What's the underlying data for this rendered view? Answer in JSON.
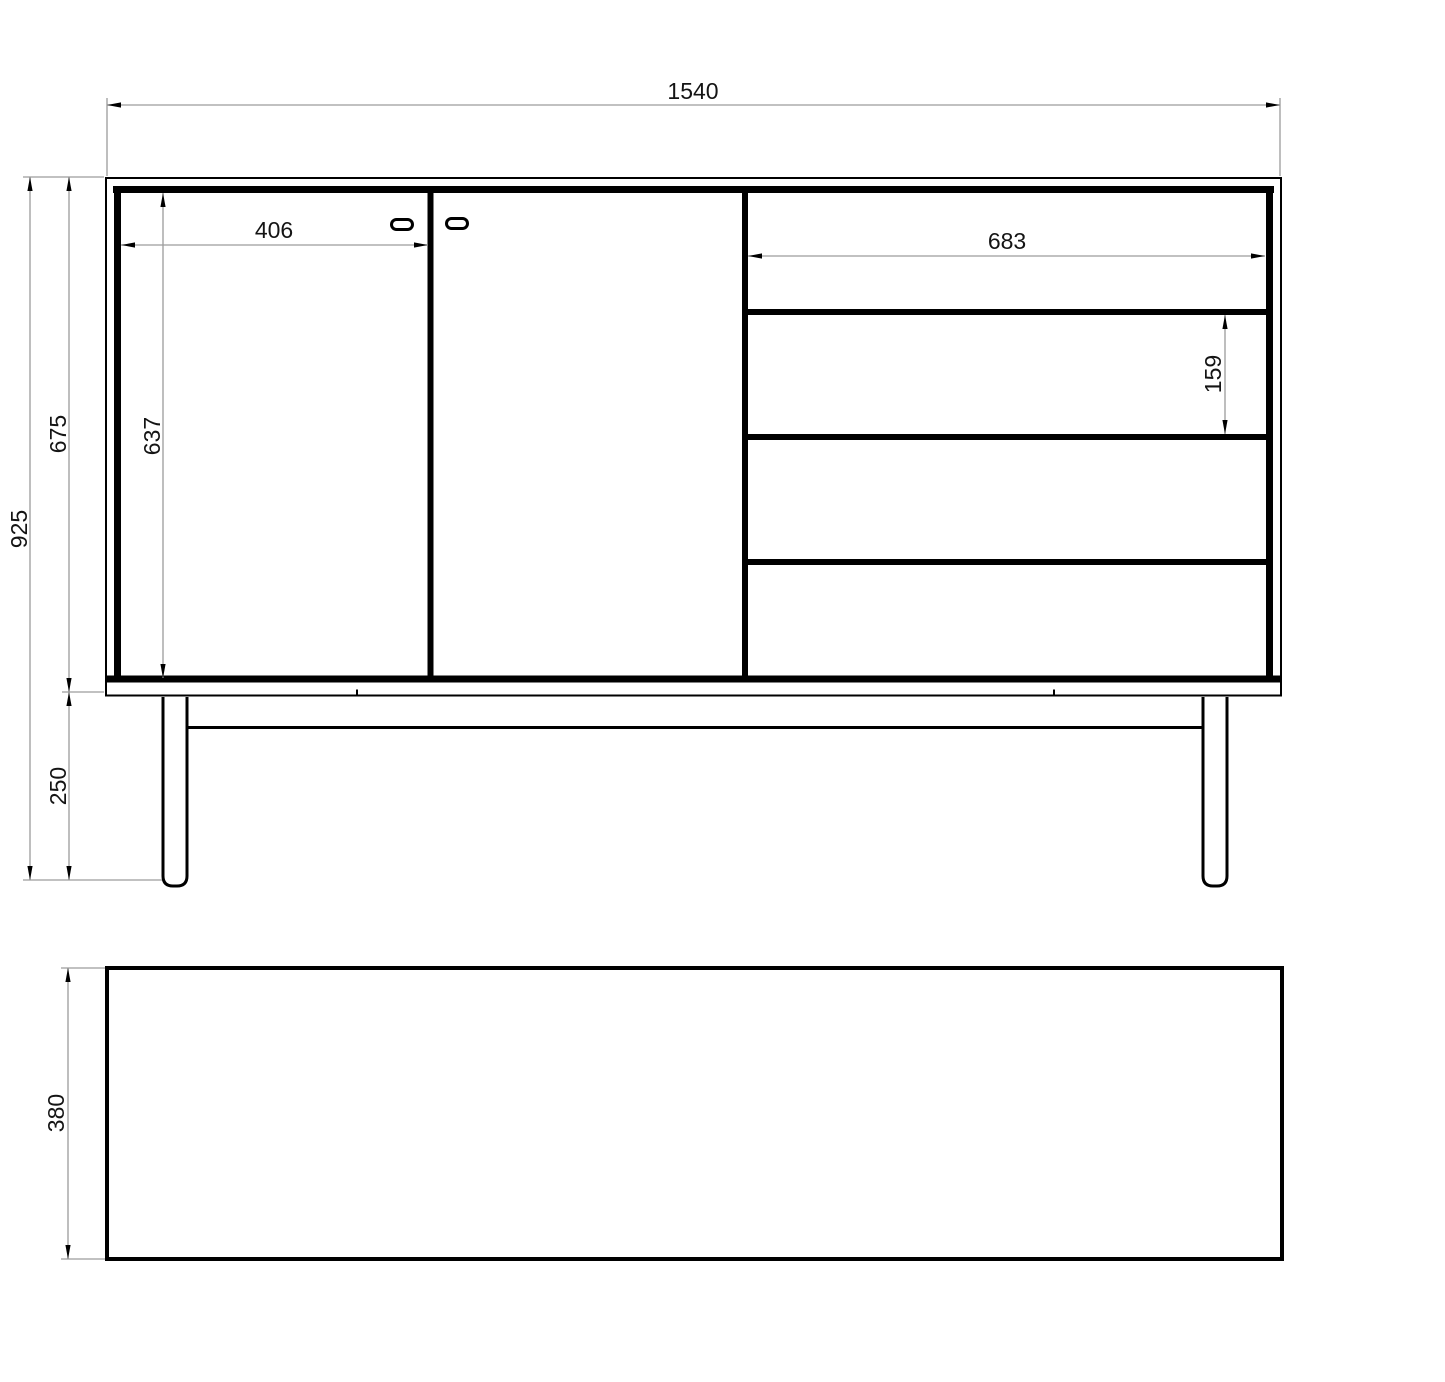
{
  "drawing": {
    "type": "furniture-technical-drawing",
    "views": {
      "front_label": "",
      "top_label": ""
    },
    "dimensions": {
      "overall_width": "1540",
      "overall_height": "925",
      "carcass_height": "675",
      "leg_height": "250",
      "door_height": "637",
      "door_width": "406",
      "drawer_width": "683",
      "drawer_height": "159",
      "depth": "380"
    },
    "colors": {
      "object_line": "#000000",
      "dimension_line": "#9c9c9c",
      "text": "#141414",
      "background": "#ffffff"
    }
  }
}
